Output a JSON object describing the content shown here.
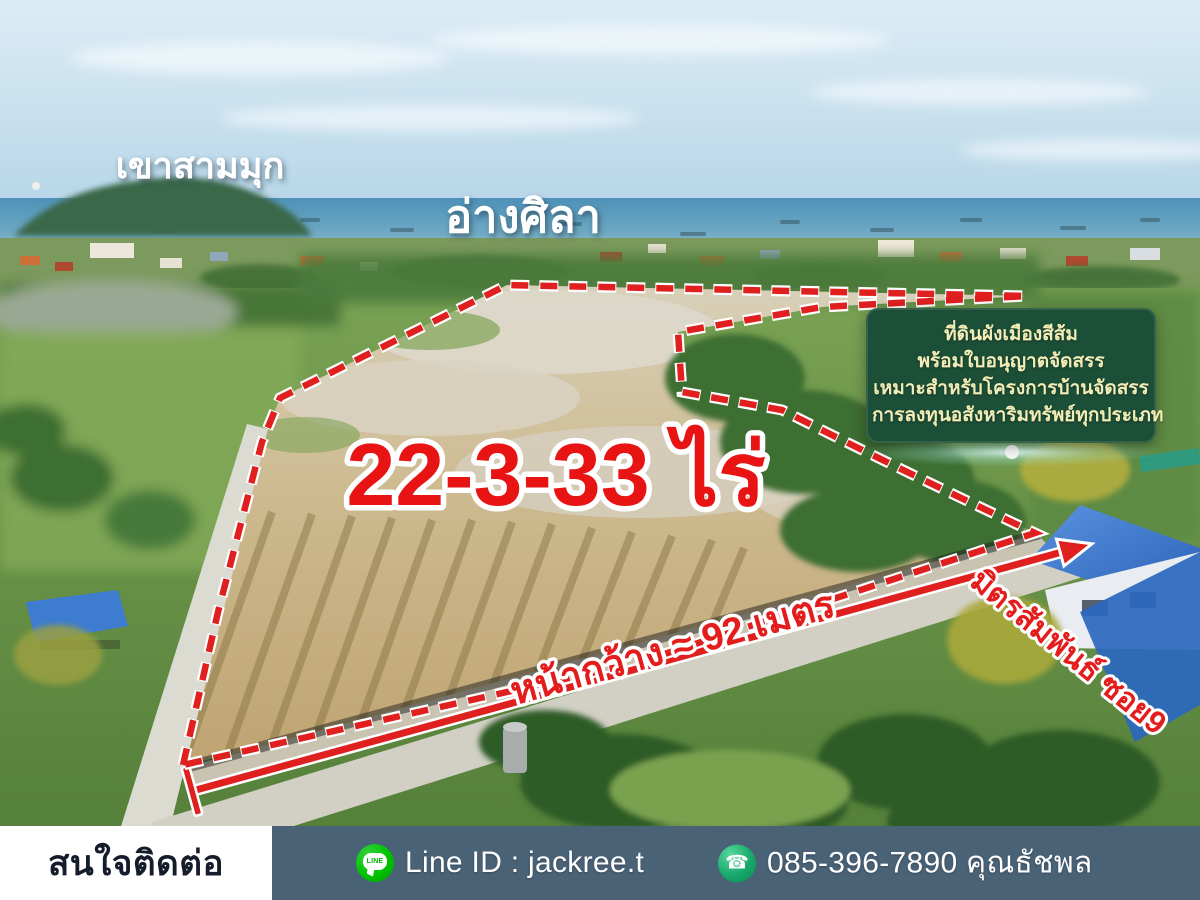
{
  "scene": {
    "hill_label": "เขาสามมุก",
    "bay_label": "อ่างศิลา",
    "area_label": "22-3-33 ไร่",
    "frontage_label": "หน้ากว้าง ≈ 92 เมตร",
    "road_label": "มิตรสัมพันธ์ ซอย9"
  },
  "info_box": {
    "lines": [
      "ที่ดินผังเมืองสีส้ม",
      "พร้อมใบอนุญาตจัดสรร",
      "เหมาะสำหรับโครงการบ้านจัดสรร",
      "การลงทุนอสังหาริมทรัพย์ทุกประเภท"
    ],
    "bg_color": "#1c4f38",
    "text_color": "#f2edb6"
  },
  "contact_bar": {
    "heading": "สนใจติดต่อ",
    "line_icon": "line-messenger-icon",
    "line_icon_text": "LINE",
    "line_id": "Line ID : jackree.t",
    "phone_icon": "phone-icon",
    "phone_glyph": "☎",
    "phone": "085-396-7890 คุณธัชพล",
    "bar_color": "#4a6276",
    "panel_color": "#ffffff"
  },
  "colors": {
    "boundary_red": "#e01f1f",
    "area_text_red": "#e81414",
    "sea_blue": "#4e92b8",
    "roof_blue": "#3c79d0"
  }
}
